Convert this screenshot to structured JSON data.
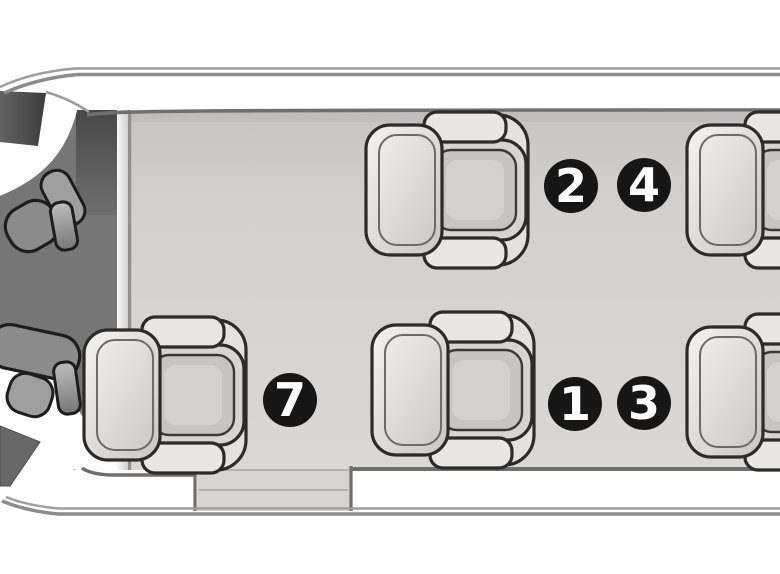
{
  "diagram": {
    "type": "aircraft-cabin-seating-layout-top-view",
    "description": "Top-down interior floorplan of a small aircraft cabin: cockpit at left, five club passenger seats facing right, numbered seat badges",
    "badges": [
      {
        "label": "2",
        "x": 571,
        "y": 186
      },
      {
        "label": "4",
        "x": 644,
        "y": 185
      },
      {
        "label": "7",
        "x": 290,
        "y": 400
      },
      {
        "label": "1",
        "x": 575,
        "y": 404
      },
      {
        "label": "3",
        "x": 644,
        "y": 403
      }
    ],
    "seat_rows": [
      {
        "name": "top",
        "visible_seats": 2
      },
      {
        "name": "bottom",
        "visible_seats": 3
      }
    ],
    "colors": {
      "background": "#ffffff",
      "cabin_floor": "#d4d3d1",
      "cockpit": "#767676",
      "hull_line": "#8b8b8b",
      "wall_line": "#6f6f6f",
      "seat_outline": "#2b2b2b",
      "badge_fill": "#161616",
      "badge_text": "#ffffff"
    }
  }
}
